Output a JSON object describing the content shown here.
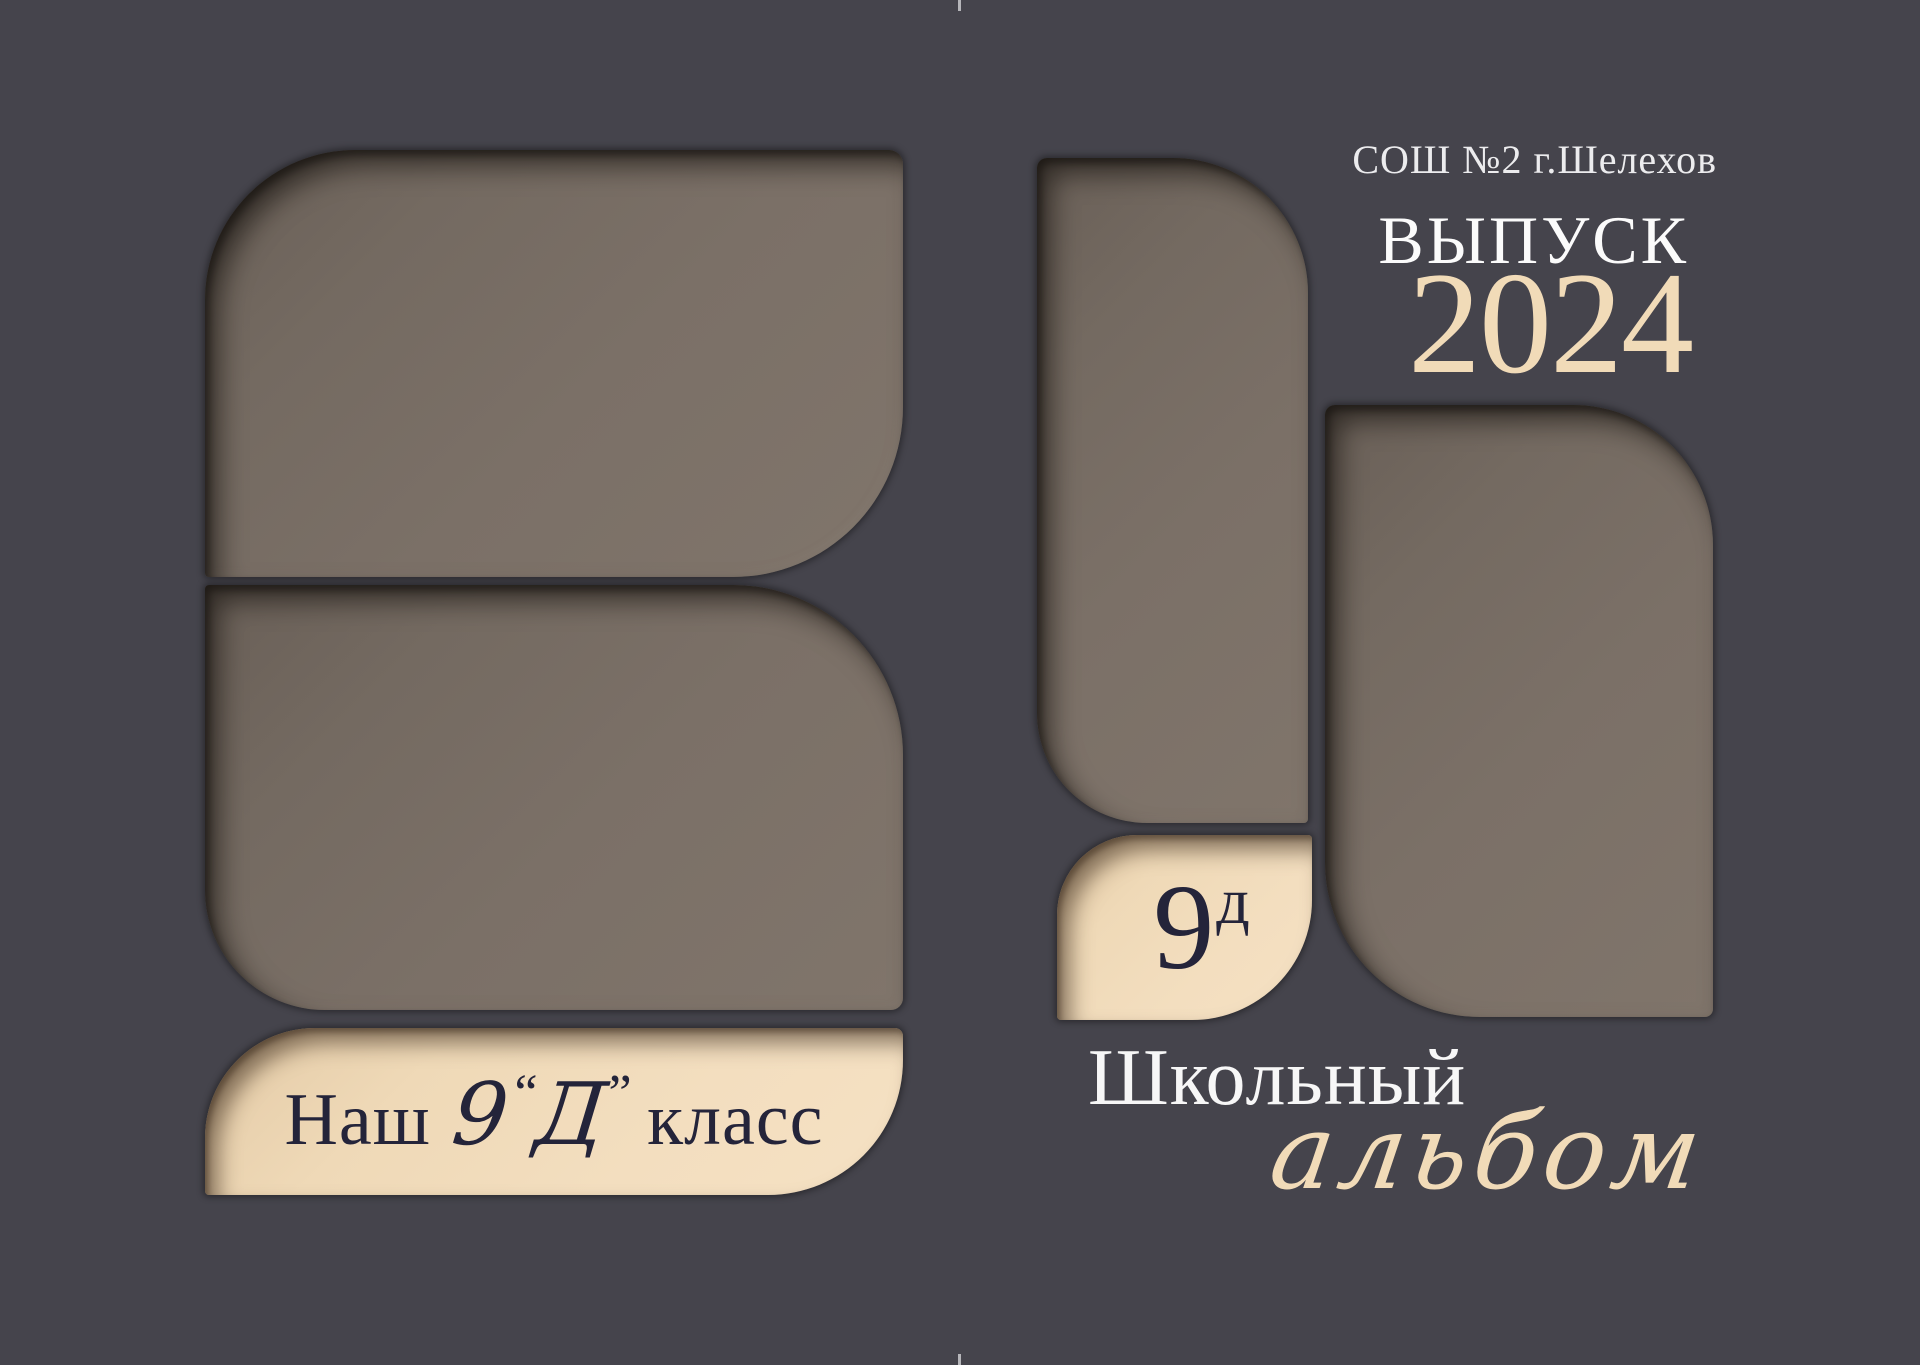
{
  "cover": {
    "school": "СОШ №2 г.Шелехов",
    "edition_label": "ВЫПУСК",
    "year": "2024",
    "title_line1": "Школьный",
    "title_line2": "альбом",
    "badge": {
      "number": "9",
      "letter": "д"
    },
    "banner": {
      "prefix": "Наш",
      "number": "9",
      "quote_open": "“",
      "letter": "Д",
      "quote_close": "”",
      "suffix": " класс"
    },
    "colors": {
      "background": "#45444c",
      "photo_block": "#7b7067",
      "cream": "#f2dcba",
      "navy_text": "#24243a",
      "white_text": "#f7f7f7"
    }
  }
}
